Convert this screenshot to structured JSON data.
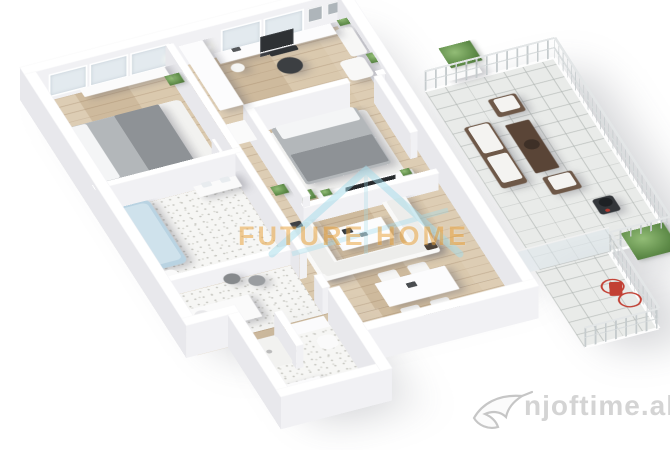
{
  "watermarks": {
    "center_logo_text": "FUTURE HOME",
    "center_logo_icon": "house-outline-icon",
    "center_text_color": "#e9a440",
    "center_icon_color": "#a4dbea",
    "corner_logo_text": "njoftime.al",
    "corner_logo_icon": "swallow-bird-icon",
    "corner_text_color": "#d4d4d4"
  },
  "scene_palette": {
    "background": "#ffffff",
    "wall_top": "#ffffff",
    "wall_face": "#f1f1f4",
    "wall_side": "#e8e8ec",
    "wood_floor": "#d8c5a8",
    "terrace_tile": "#e9ebe9",
    "bathroom_tile": "#f6f6f4",
    "bed_gray": "#b3b7ba",
    "sofa_white": "#f9f9f8",
    "plant_green": "#5f8c49",
    "bathtub_blue": "#b9d3e2",
    "outdoor_wood": "#6e5848",
    "bike_red": "#c24034",
    "railing_gray": "#c5cbcd",
    "tv_dark": "#26292c"
  }
}
